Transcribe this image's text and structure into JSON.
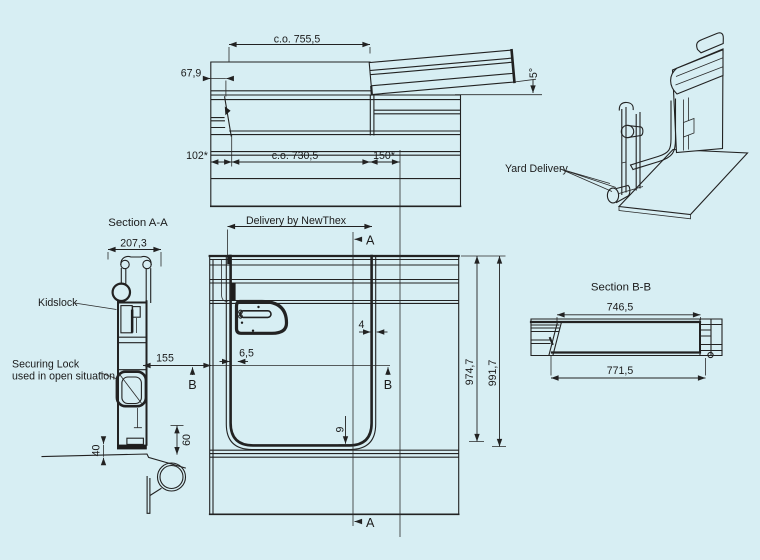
{
  "colors": {
    "background": "#d7eef3",
    "line": "#222222",
    "text": "#1b1b1b"
  },
  "top_view": {
    "dim_width_total": "c.o. 755,5",
    "dim_left_offset": "67,9",
    "dim_left_margin": "102*",
    "dim_opening": "c.o. 730,5",
    "dim_right_margin": "150*",
    "dim_flap_angle": "5°"
  },
  "iso_view": {
    "label_yard_delivery": "Yard Delivery"
  },
  "section_a": {
    "title": "Section A-A",
    "dim_width": "207,3",
    "label_kidslock": "Kidslock",
    "dim_offset": "155",
    "label_securing_line1": "Securing Lock",
    "label_securing_line2": "used in open situation",
    "dim_lower_gap": "40",
    "dim_lower_height": "60"
  },
  "front_view": {
    "label_delivery": "Delivery by NewThex",
    "section_marker_a": "A",
    "section_marker_b": "B",
    "dim_edge_gap": "6,5",
    "dim_right_gap": "4",
    "dim_bottom_gap": "9",
    "dim_height_opening": "974,7",
    "dim_height_total": "991,7"
  },
  "section_b": {
    "title": "Section B-B",
    "dim_inner": "746,5",
    "dim_outer": "771,5"
  }
}
